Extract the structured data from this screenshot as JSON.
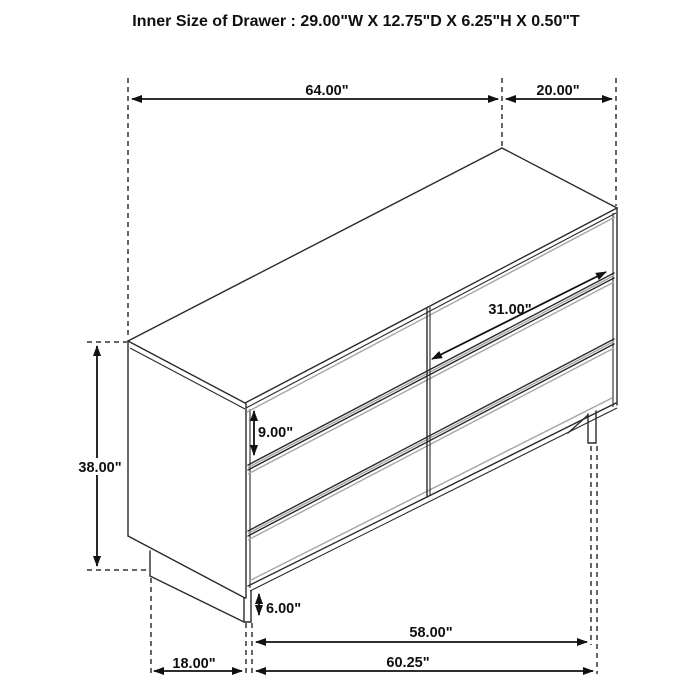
{
  "title": "Inner Size of Drawer : 29.00\"W X 12.75\"D X 6.25\"H X 0.50\"T",
  "dims": {
    "top_width": "64.00\"",
    "top_depth": "20.00\"",
    "overall_height": "38.00\"",
    "drawer_height": "9.00\"",
    "drawer_inner_width": "31.00\"",
    "base_height": "6.00\"",
    "leg_to_leg": "58.00\"",
    "base_depth": "18.00\"",
    "overall_width": "60.25\""
  },
  "colors": {
    "line": "#2a2a2a",
    "accent_gray": "#a3a7aa",
    "dimension": "#111111",
    "background": "#ffffff",
    "text": "#0f0f0f"
  }
}
